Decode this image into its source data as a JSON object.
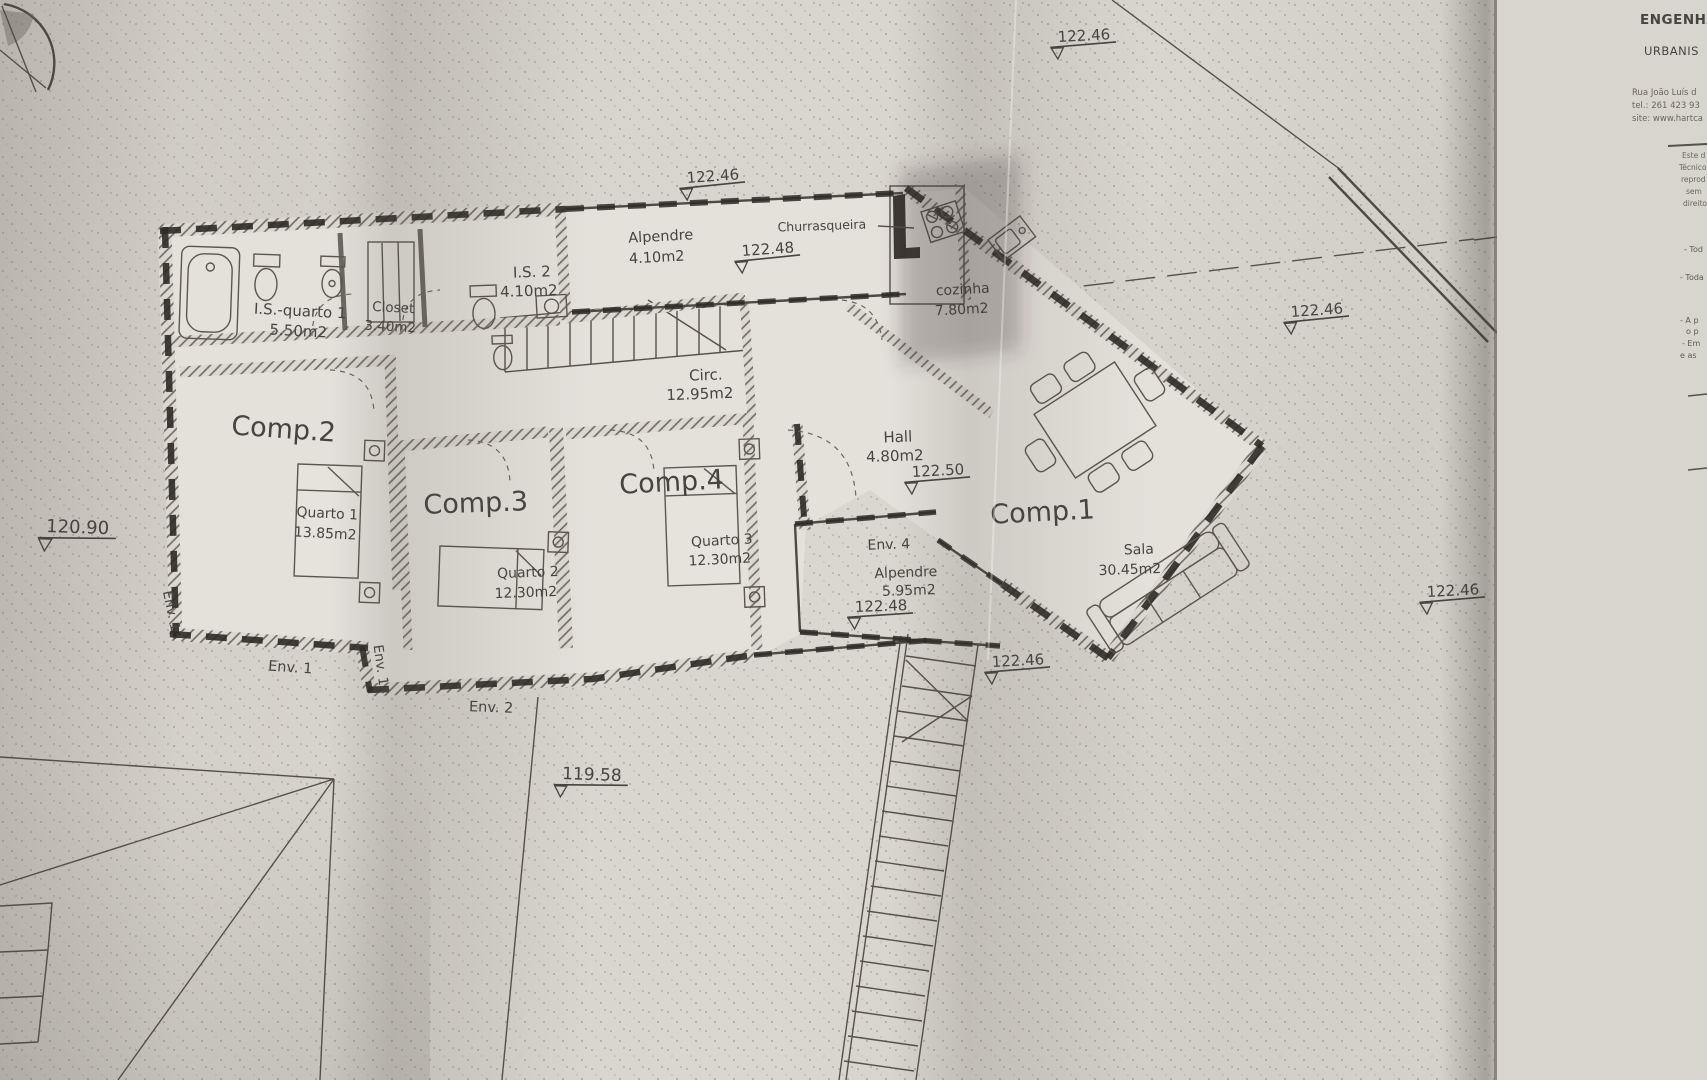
{
  "rooms": {
    "comp1": {
      "label": "Comp.1",
      "name": "Sala",
      "area": "30.45m2"
    },
    "comp2": {
      "label": "Comp.2",
      "name": "Quarto 1",
      "area": "13.85m2"
    },
    "comp3": {
      "label": "Comp.3",
      "name": "Quarto 2",
      "area": "12.30m2"
    },
    "comp4": {
      "label": "Comp.4",
      "name": "Quarto 3",
      "area": "12.30m2"
    },
    "is_quarto1": {
      "name": "I.S.-quarto 1",
      "area": "5.50m2"
    },
    "closet": {
      "name": "Closet",
      "area": "3.40m2"
    },
    "is2": {
      "name": "I.S. 2",
      "area": "4.10m2"
    },
    "alpendre_top": {
      "name": "Alpendre",
      "area": "4.10m2"
    },
    "churrasqueira": {
      "name": "Churrasqueira"
    },
    "cozinha": {
      "name": "cozinha",
      "area": "7.80m2"
    },
    "circ": {
      "name": "Circ.",
      "area": "12.95m2"
    },
    "hall": {
      "name": "Hall",
      "area": "4.80m2"
    },
    "env4": {
      "label": "Env. 4",
      "name": "Alpendre",
      "area": "5.95m2"
    }
  },
  "env_labels": {
    "env1": "Env. 1",
    "env2": "Env. 2",
    "env13": "Env. 13",
    "env14": "Env. 14"
  },
  "levels": [
    {
      "id": "top",
      "value": "122.46"
    },
    {
      "id": "alpendre-top",
      "value": "122.46"
    },
    {
      "id": "alpendre",
      "value": "122.48"
    },
    {
      "id": "hall",
      "value": "122.50"
    },
    {
      "id": "env4",
      "value": "122.48"
    },
    {
      "id": "right-upper",
      "value": "122.46"
    },
    {
      "id": "right-lower",
      "value": "122.46"
    },
    {
      "id": "sala-sw",
      "value": "122.46"
    },
    {
      "id": "west",
      "value": "120.90"
    },
    {
      "id": "south",
      "value": "119.58"
    }
  ],
  "section_marker": "A",
  "title_block": {
    "firm_line1": "ENGENHA",
    "firm_line2": "URBANIS",
    "address1": "Rua João Luís d",
    "address2": "tel.: 261 423 93",
    "address3": "site: www.hartca",
    "fine1": "Este d",
    "fine2": "Técnico",
    "fine3": "reprod",
    "fine4": "sem",
    "fine5": "direito",
    "note1": "- Tod",
    "note2": "- Toda",
    "note3": "- A p",
    "note4": "o p",
    "note5": "- Em",
    "note6": "e as"
  }
}
